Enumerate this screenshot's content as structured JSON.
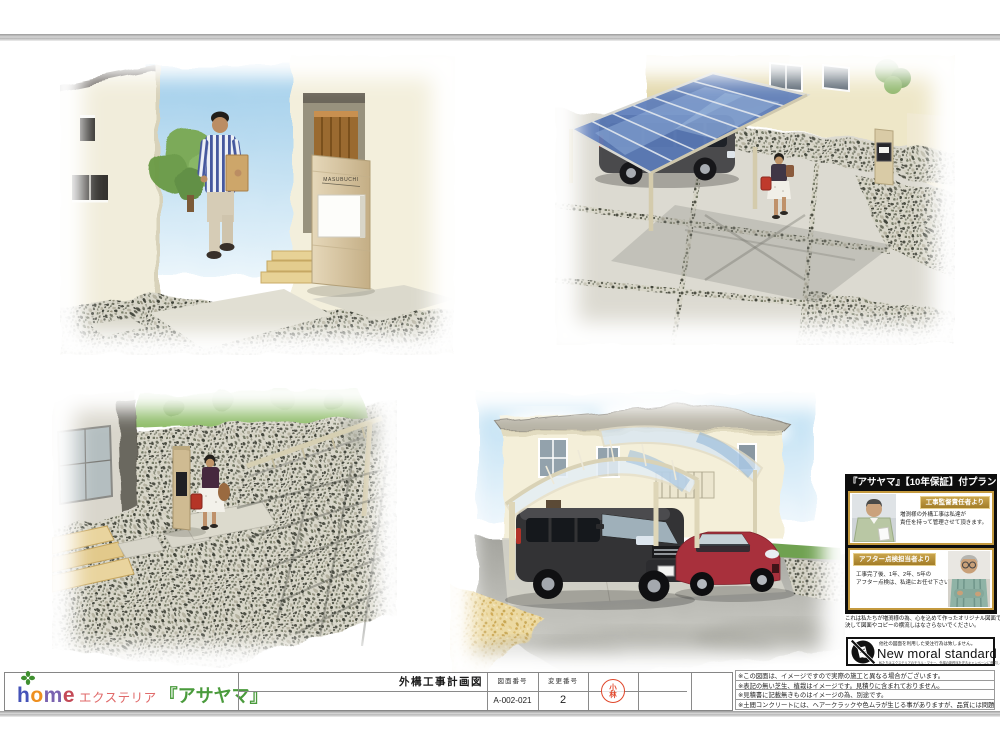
{
  "scenes": {
    "entrance": {
      "nameplate": "MASUBUCHI"
    }
  },
  "warranty": {
    "header": "『アサヤマ』【10年保証】付プラン",
    "supervisor_label": "工事監督責任者より",
    "supervisor_msg1": "増渕様の外構工事は私達が",
    "supervisor_msg2": "責任を持って管理させて頂きます。",
    "after_label": "アフター点検担当者より",
    "after_msg1": "工事完了後、1年、2年、5年の",
    "after_msg2": "アフター点検は、私達にお任せ下さい。",
    "origin1": "これは私たちが増渕様の為、心を込めて作ったオリジナル図面です。",
    "origin2": "決して図面やコピーの横流しはなさらないでください。"
  },
  "moral": {
    "claim": "他社の図面を利用した受注行為は致しません。",
    "brand": "New moral standard",
    "subtext": "私たちはエクステリアのモラル・マナー、外構の新秩序を守るキャンペーンに賛同しています。"
  },
  "title_block": {
    "title": "外構工事計画図",
    "no_label": "図面番号",
    "no_value": "A-002-021",
    "rev_label": "変更番号",
    "rev_value": "2"
  },
  "stamp": {
    "l1": "小",
    "l2": "林"
  },
  "logo": {
    "l1": "h",
    "l2": "o",
    "l3": "m",
    "l4": "e",
    "suffix": "エクステリア",
    "brand": "『アサヤマ』"
  },
  "notes": [
    "※この図面は、イメージですので実際の施工と異なる場合がございます。",
    "※表記の無い芝生、植栽はイメージです。見積りに含まれておりません。",
    "※見積書に記載無きものはイメージの為、別途です。",
    "※土間コンクリートには、ヘアークラックや色ムラが生じる事がありますが、品質には問題ありません。"
  ],
  "colors": {
    "gold": "#c49a3f",
    "stamp_red": "#e0472b",
    "logo_green": "#4a9b3c",
    "logo_red": "#e06a6a",
    "roof_blue": "#5b7cba",
    "panel_black": "#0d0d0d"
  }
}
